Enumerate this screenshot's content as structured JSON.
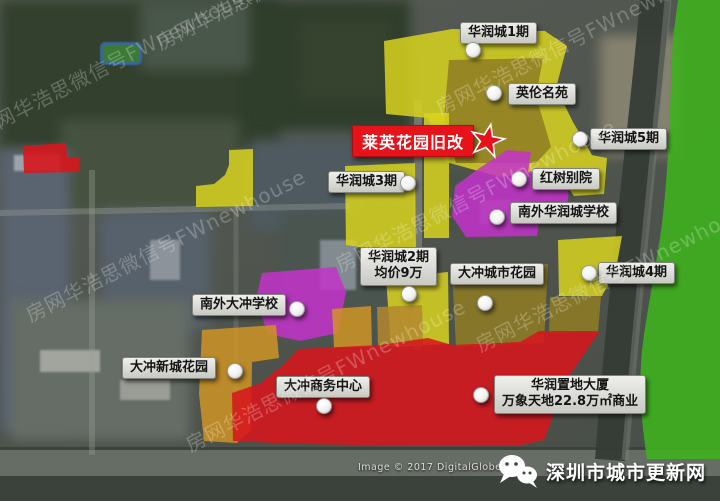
{
  "title_label": {
    "text": "莱英花园旧改"
  },
  "labels": [
    {
      "text": "华润城1期",
      "x": 460,
      "y": 22,
      "dot_x": 473,
      "dot_y": 50
    },
    {
      "text": "英伦名苑",
      "x": 508,
      "y": 83,
      "dot_x": 494,
      "dot_y": 93
    },
    {
      "text": "华润城5期",
      "x": 590,
      "y": 128,
      "dot_x": 580,
      "dot_y": 139
    },
    {
      "text": "华润城3期",
      "x": 328,
      "y": 171,
      "dot_x": 408,
      "dot_y": 183
    },
    {
      "text": "红树别院",
      "x": 532,
      "y": 168,
      "dot_x": 519,
      "dot_y": 179
    },
    {
      "text": "南外华润城学校",
      "x": 510,
      "y": 202,
      "dot_x": 497,
      "dot_y": 217
    },
    {
      "text": "华润城2期",
      "text2": "均价9万",
      "x": 360,
      "y": 247,
      "dot_x": 409,
      "dot_y": 294
    },
    {
      "text": "大冲城市花园",
      "x": 450,
      "y": 263,
      "dot_x": 485,
      "dot_y": 303
    },
    {
      "text": "华润城4期",
      "x": 598,
      "y": 262,
      "dot_x": 589,
      "dot_y": 273
    },
    {
      "text": "南外大冲学校",
      "x": 192,
      "y": 294,
      "dot_x": 297,
      "dot_y": 309
    },
    {
      "text": "大冲新城花园",
      "x": 122,
      "y": 357,
      "dot_x": 235,
      "dot_y": 371
    },
    {
      "text": "大冲商务中心",
      "x": 276,
      "y": 376,
      "dot_x": 324,
      "dot_y": 406
    },
    {
      "text": "华润置地大厦",
      "text2": "万象天地22.8万㎡商业",
      "x": 494,
      "y": 375,
      "dot_x": 481,
      "dot_y": 395
    }
  ],
  "watermark": {
    "text": "房网华浩思微信号FWnewhouse"
  },
  "attribution": "Image © 2017 DigitalGlobe",
  "branding": {
    "text": "深圳市城市更新网"
  },
  "colors": {
    "yellow": "#d8d41e",
    "olive": "#8f7d24",
    "magenta": "#c433cb",
    "red": "#d6161d",
    "orange": "#cf9425",
    "tan": "#b3872e",
    "green": "#3fb01e"
  }
}
